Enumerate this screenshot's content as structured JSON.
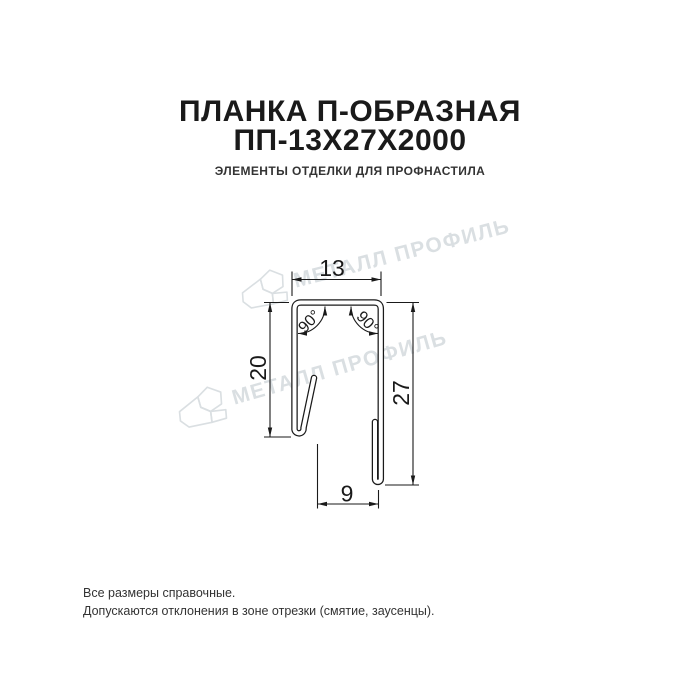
{
  "header": {
    "title_line1": "ПЛАНКА П-ОБРАЗНАЯ",
    "title_line2": "ПП-13Х27Х2000",
    "subtitle": "ЭЛЕМЕНТЫ ОТДЕЛКИ ДЛЯ ПРОФНАСТИЛА"
  },
  "drawing": {
    "type": "technical-cross-section",
    "product": "U-shaped strip profile",
    "dims": {
      "top_width": "13",
      "left_height": "20",
      "right_height": "27",
      "bottom_width": "9"
    },
    "angles": {
      "left": "90°",
      "right": "90°"
    }
  },
  "watermark": {
    "text": "МЕТАЛЛ ПРОФИЛЬ",
    "color": "#dadfe2"
  },
  "footer": {
    "line1": "Все размеры справочные.",
    "line2": "Допускаются отклонения в зоне отрезки (смятие, заусенцы)."
  },
  "colors": {
    "background": "#ffffff",
    "line": "#1a1a1a",
    "title": "#1a1a1a",
    "subtitle": "#333333"
  }
}
